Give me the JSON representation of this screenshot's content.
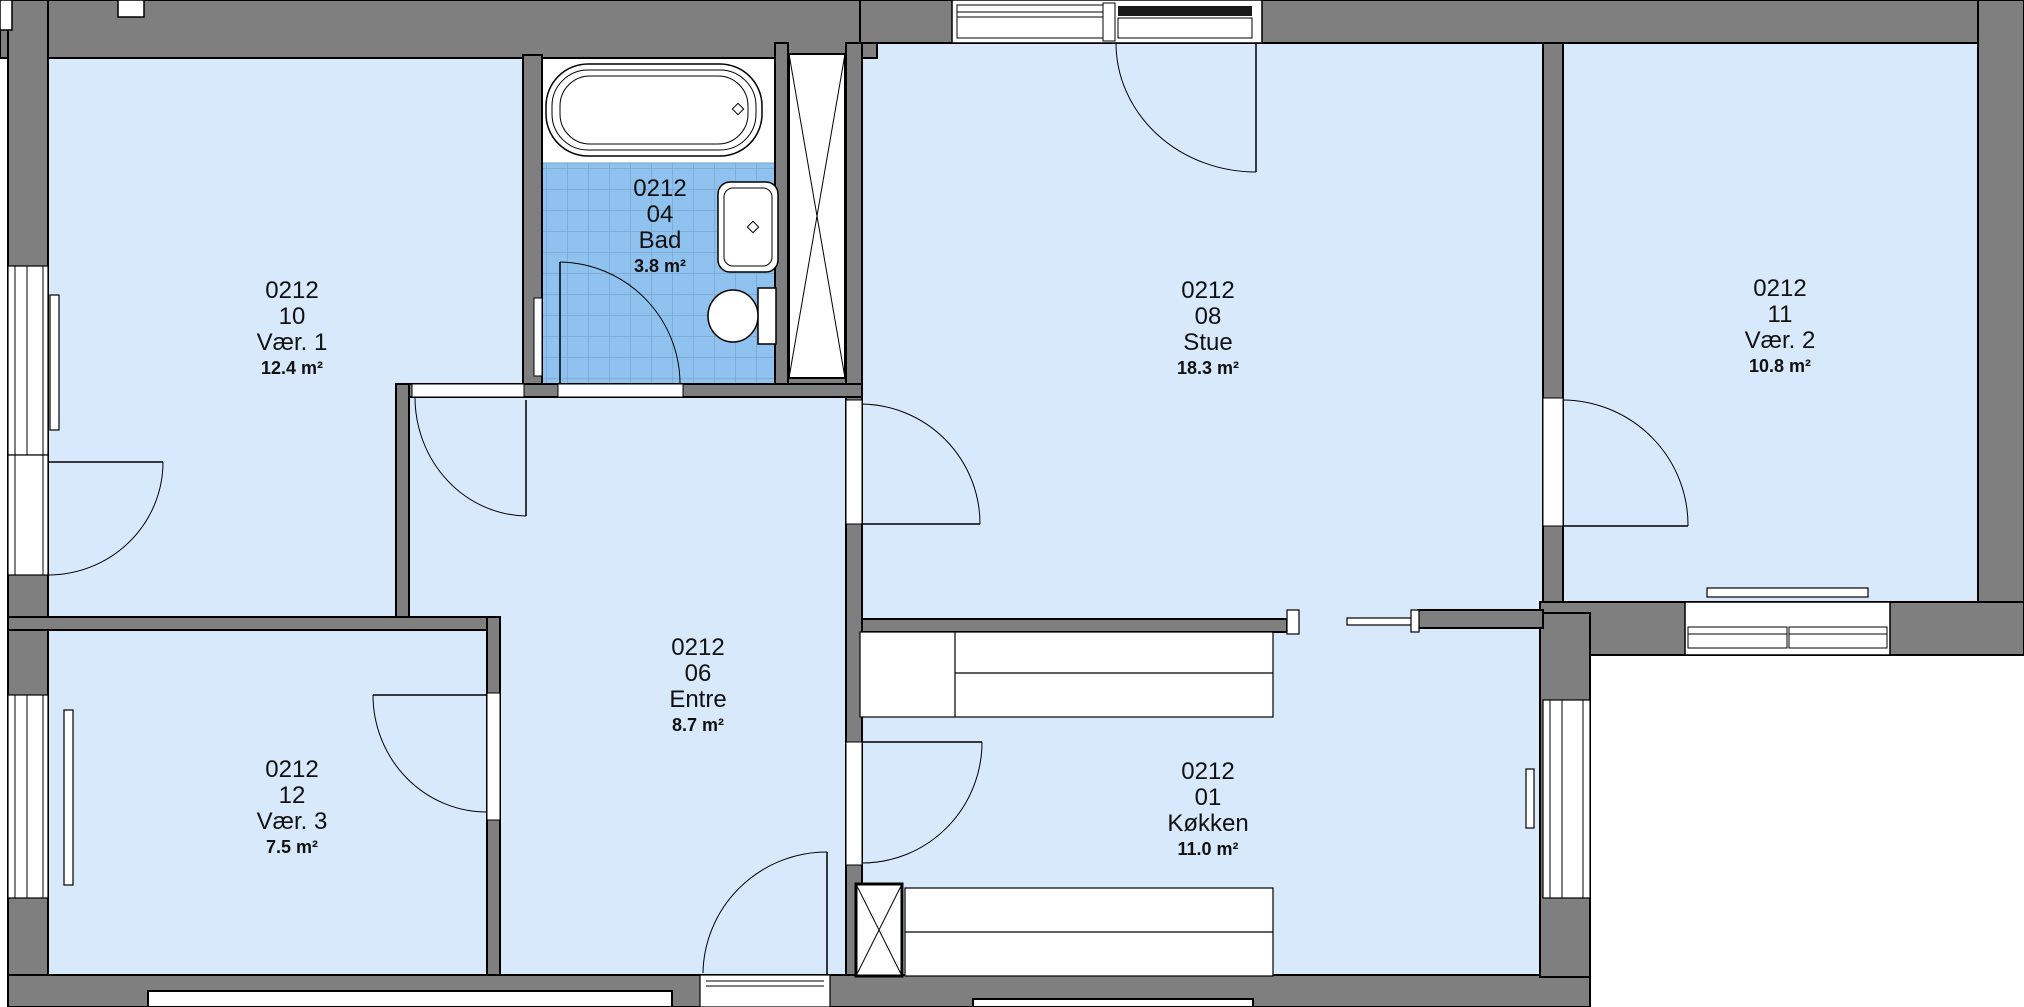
{
  "plan_title": "Floor plan unit 0212",
  "rooms": {
    "vaer1": {
      "unit": "0212",
      "number": "10",
      "name": "Vær. 1",
      "area": "12.4 m²"
    },
    "bad": {
      "unit": "0212",
      "number": "04",
      "name": "Bad",
      "area": "3.8 m²"
    },
    "entre": {
      "unit": "0212",
      "number": "06",
      "name": "Entre",
      "area": "8.7 m²"
    },
    "stue": {
      "unit": "0212",
      "number": "08",
      "name": "Stue",
      "area": "18.3 m²"
    },
    "koekken": {
      "unit": "0212",
      "number": "01",
      "name": "Køkken",
      "area": "11.0 m²"
    },
    "vaer2": {
      "unit": "0212",
      "number": "11",
      "name": "Vær. 2",
      "area": "10.8 m²"
    },
    "vaer3": {
      "unit": "0212",
      "number": "12",
      "name": "Vær. 3",
      "area": "7.5 m²"
    }
  },
  "colors": {
    "floor": "#D8E9FB",
    "tile": "#8FC2EE",
    "tile_grid": "#79A5C9",
    "wall": "#7F7F7F",
    "outline": "#000000",
    "background": "#FFFFFF"
  }
}
